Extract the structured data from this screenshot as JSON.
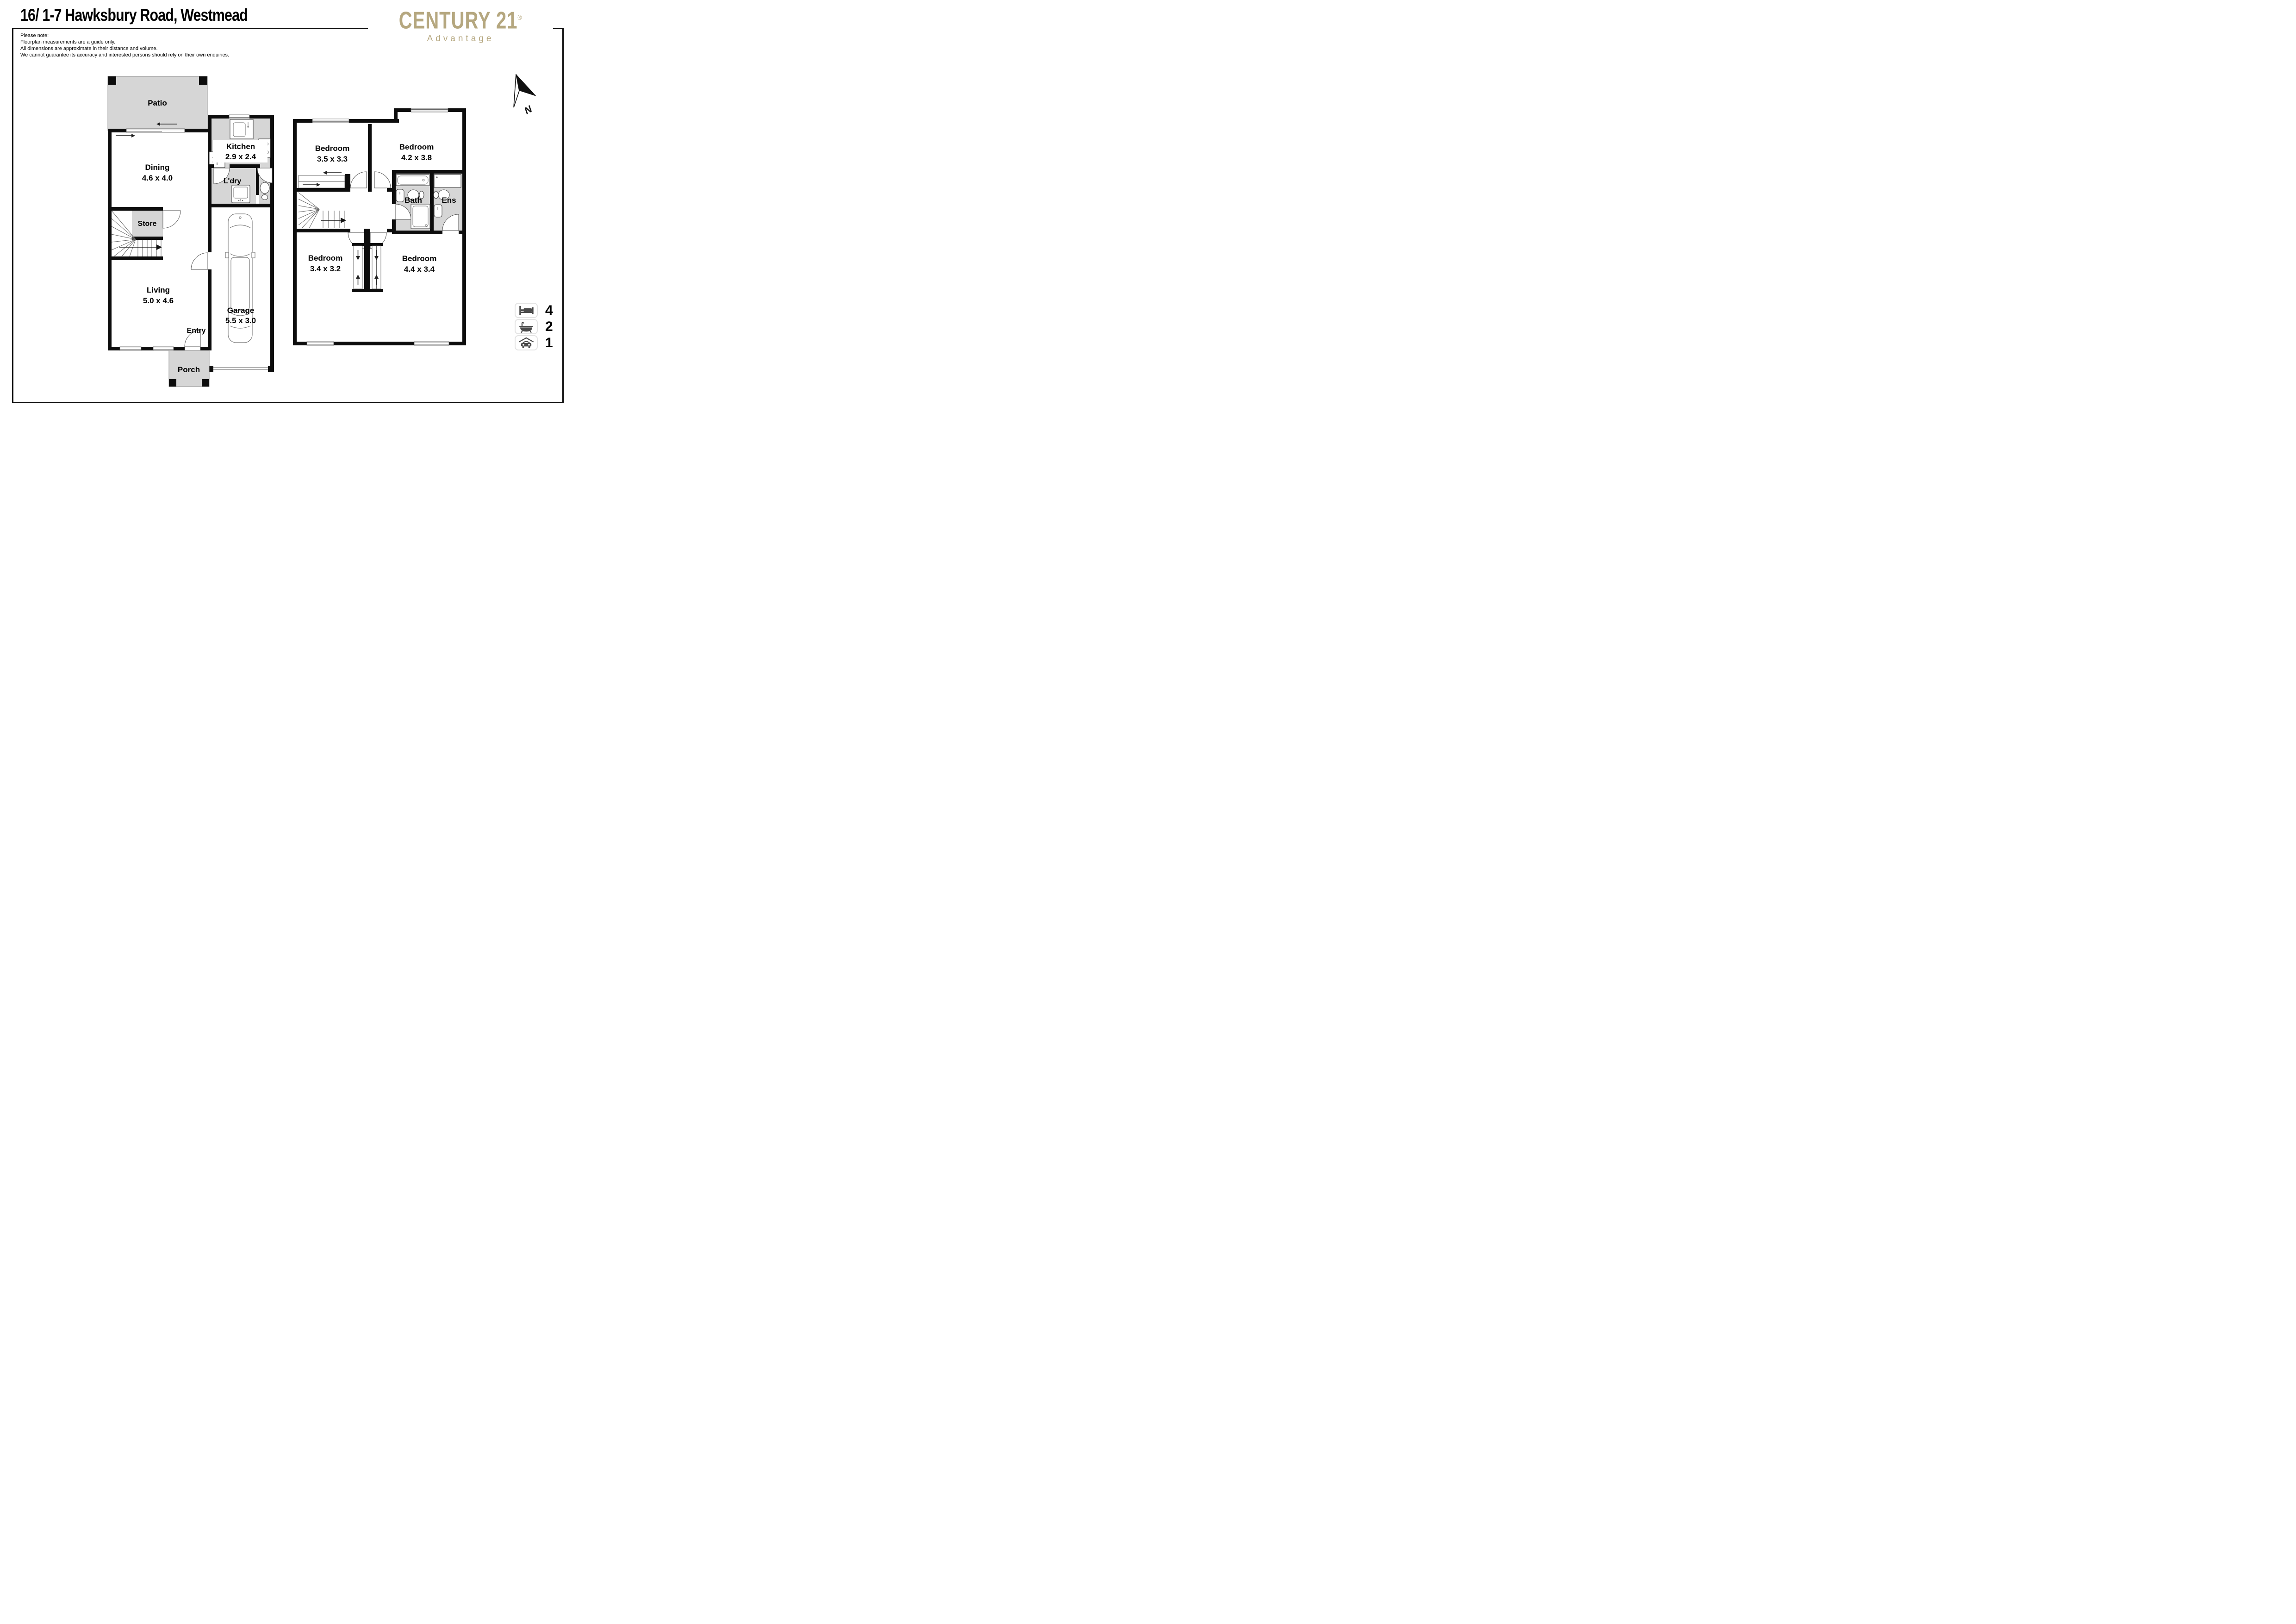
{
  "title": "16/ 1-7 Hawksbury Road, Westmead",
  "disclaimer": {
    "heading": "Please note:",
    "line1": "Floorplan measurements are a guide only.",
    "line2": "All dimensions are approximate in their distance and volume.",
    "line3": "We cannot guarantee its accuracy and interested persons should rely on their own enquiries."
  },
  "brand": {
    "wordmark": "CENTURY 21",
    "registered": "®",
    "tagline": "Advantage",
    "gold_color": "#b5a77f"
  },
  "compass": {
    "label": "N"
  },
  "ground_floor": {
    "rooms": [
      {
        "name": "Patio",
        "dims": ""
      },
      {
        "name": "Kitchen",
        "dims": "2.9 x 2.4"
      },
      {
        "name": "Dining",
        "dims": "4.6 x 4.0"
      },
      {
        "name": "L'dry",
        "dims": ""
      },
      {
        "name": "Store",
        "dims": ""
      },
      {
        "name": "Living",
        "dims": "5.0 x 4.6"
      },
      {
        "name": "Garage",
        "dims": "5.5 x 3.0"
      },
      {
        "name": "Entry",
        "dims": ""
      },
      {
        "name": "Porch",
        "dims": ""
      }
    ]
  },
  "first_floor": {
    "rooms": [
      {
        "name": "Bedroom",
        "dims": "3.5 x 3.3"
      },
      {
        "name": "Bedroom",
        "dims": "4.2 x 3.8"
      },
      {
        "name": "Bath",
        "dims": ""
      },
      {
        "name": "Ens",
        "dims": ""
      },
      {
        "name": "Bedroom",
        "dims": "3.4 x 3.2"
      },
      {
        "name": "Bedroom",
        "dims": "4.4 x 3.4"
      }
    ]
  },
  "summary": {
    "bedrooms": "4",
    "bathrooms": "2",
    "car_spaces": "1"
  },
  "icons": {
    "bed": "bed-icon",
    "bath": "bathtub-icon",
    "car": "car-garage-icon",
    "north": "north-arrow-icon"
  },
  "colors": {
    "wall": "#0d0d0d",
    "floor_gray": "#d6d6d6"
  }
}
